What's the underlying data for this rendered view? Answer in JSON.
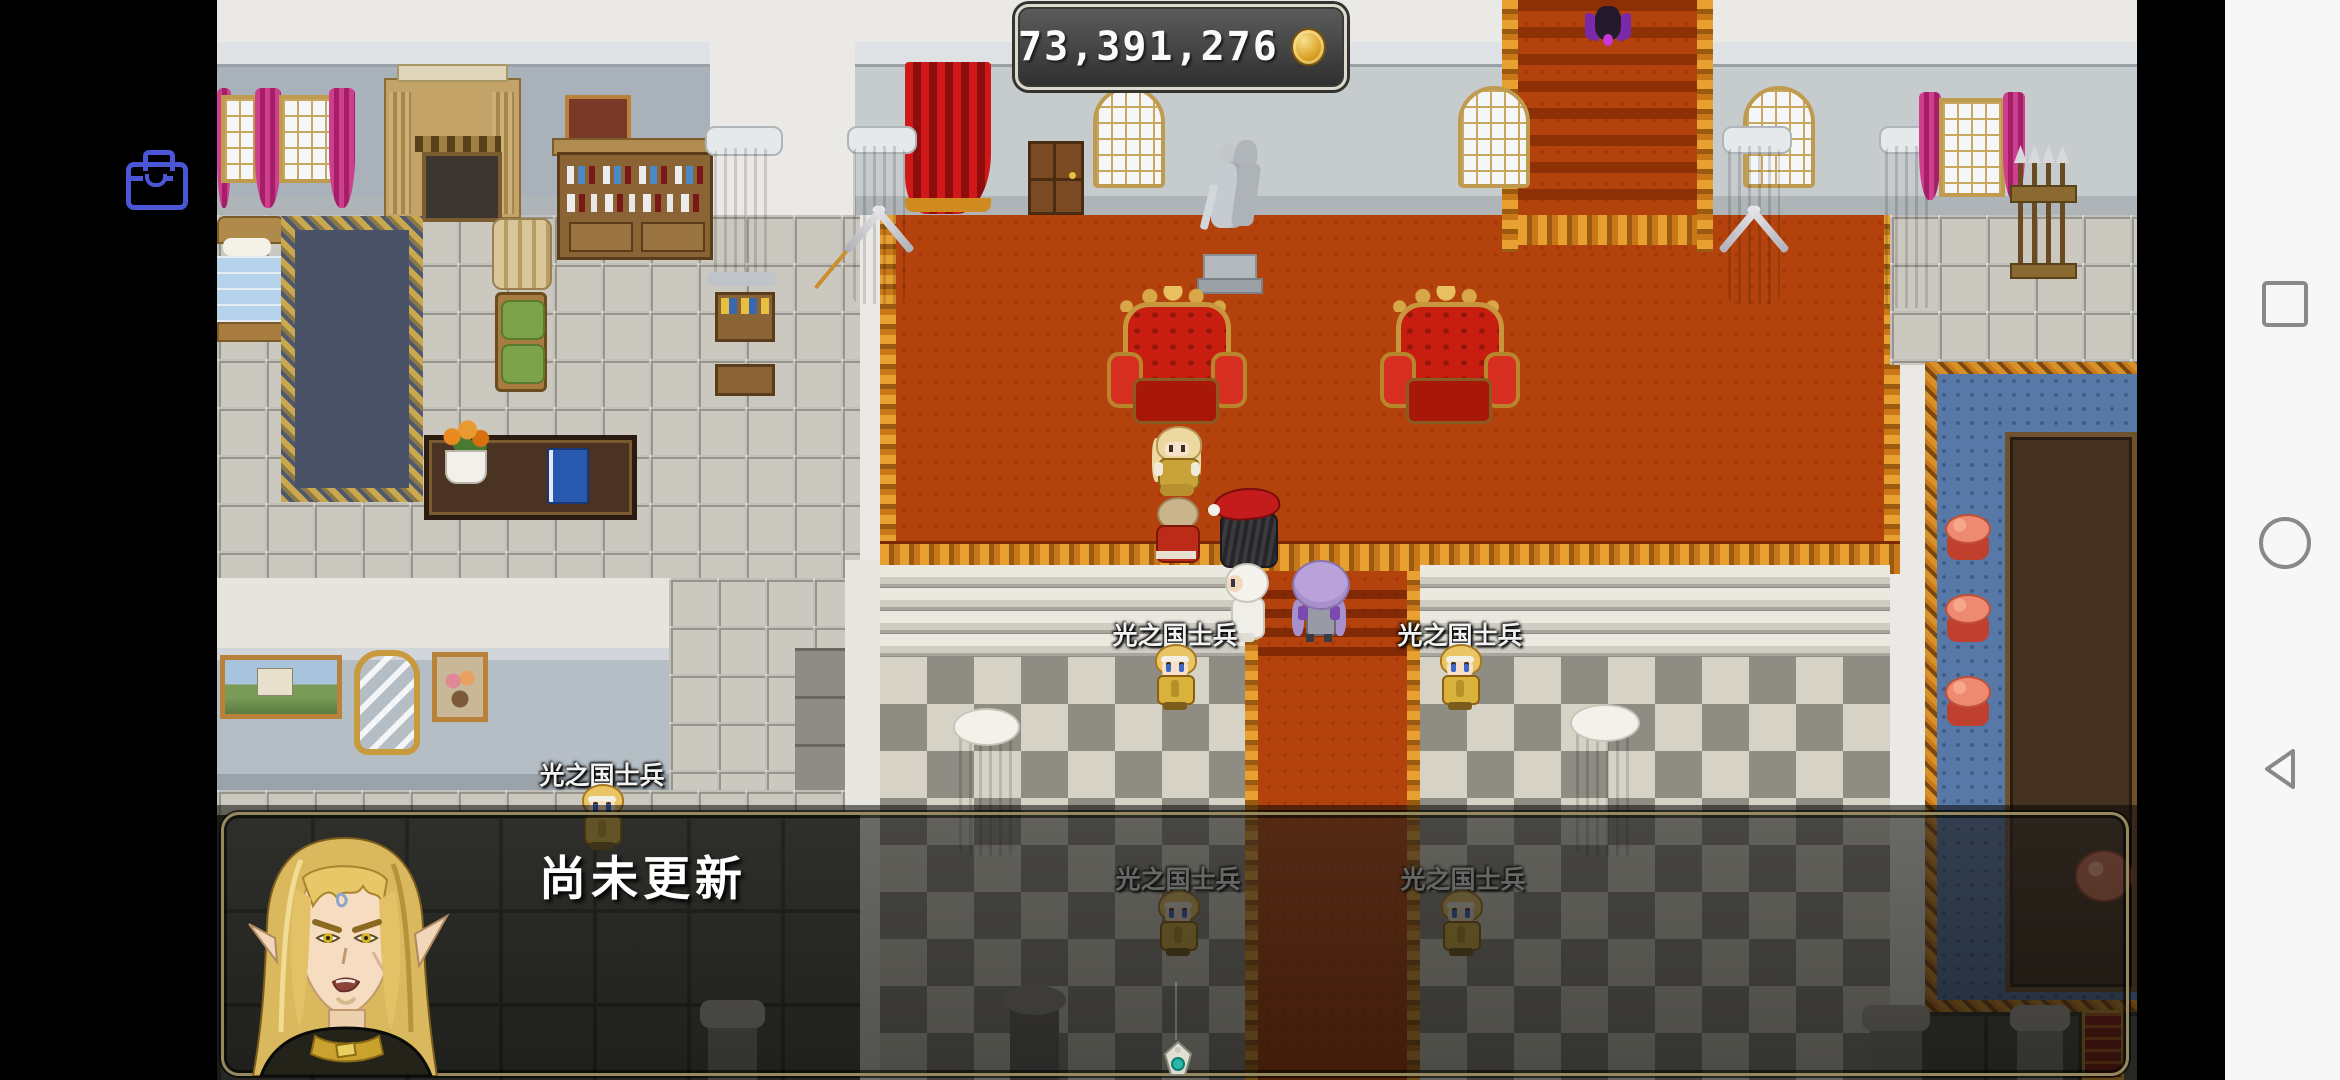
{
  "hud": {
    "gold_window": {
      "amount": "73,391,276",
      "coin_icon": "gold-coin"
    },
    "menu_button": {
      "icon": "briefcase",
      "color": "#4a56d6"
    }
  },
  "message_window": {
    "text": "尚未更新",
    "portrait": "blonde-elf-man",
    "continue_indicator": "gem-ornament"
  },
  "npcs": {
    "guard_label": "光之国士兵"
  },
  "android_nav": {
    "recents": "square-icon",
    "home": "circle-icon",
    "back": "back-triangle-icon"
  },
  "colors": {
    "carpet_orange": "#b4420c",
    "throne_red": "#c81e10",
    "gold": "#c8963c",
    "blue_carpet": "#5878a8",
    "accent_blue": "#4a56d6",
    "nav_icon_gray": "#898989"
  }
}
